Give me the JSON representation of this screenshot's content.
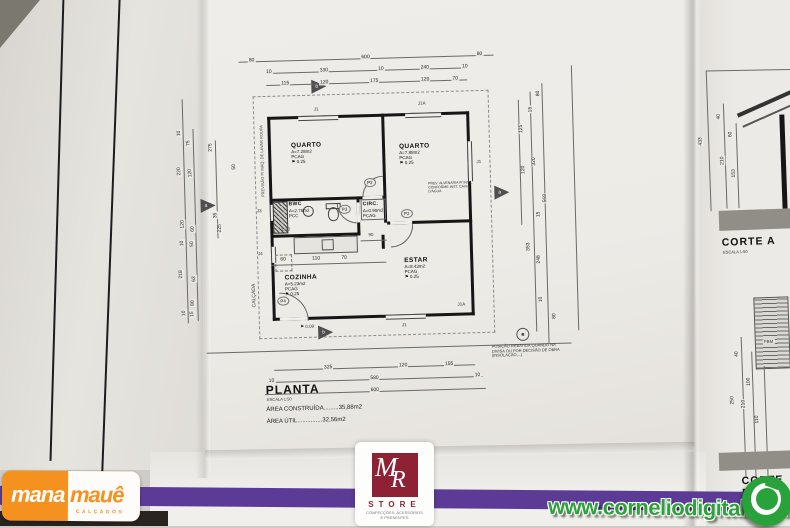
{
  "plan": {
    "title": "PLANTA",
    "scale": "ESCALA 1:50",
    "area_built": "ÁREA CONSTRUÍDA.........35,88m2",
    "area_net": "ÁREA ÚTIL...............32,56m2",
    "note_lines": [
      "POSIÇÃO REBATIDA QUANDO NA",
      "DIVISA OU POR DECISÃO DE OBRA",
      "(INSOLAÇÃO,...)"
    ],
    "annotation_lines": [
      "PREV. ALVENARIA P/ INST.",
      "CONFORME INST. CAIXA",
      "D'ÁGUA"
    ],
    "sidewalk_label": "CALÇADA",
    "laundry_note": "PREVISÃO P/ MÁQ. DE LAVAR ROUPA",
    "outside_level": "0.09",
    "rooms": [
      {
        "name": "QUARTO",
        "area": "A=7.28m2",
        "finish": "PCAG",
        "level": "0.25"
      },
      {
        "name": "QUARTO",
        "area": "A=7.88m2",
        "finish": "PCAG",
        "level": "0.25"
      },
      {
        "name": "BWC",
        "area": "A=2.76m2",
        "finish": "PCC",
        "level": "0.22"
      },
      {
        "name": "CIRC.",
        "area": "A=0.90m2",
        "finish": "PCAG",
        "level": "0.25"
      },
      {
        "name": "COZINHA",
        "area": "A=5.23m2",
        "finish": "PCAG",
        "level": "0.25"
      },
      {
        "name": "ESTAR",
        "area": "A=8.43m2",
        "finish": "PCAG",
        "level": "0.25"
      }
    ],
    "doors": [
      "P2",
      "P2",
      "P3",
      "P4"
    ],
    "windows": [
      "J1",
      "J1A",
      "J1",
      "J1",
      "J1A",
      "J3",
      "J4"
    ],
    "section_markers": [
      "b",
      "a",
      "a",
      "b"
    ],
    "bwc_height_note": "2.30",
    "dims": {
      "top_row_outer": [
        "80",
        "600",
        "80"
      ],
      "top_row_mid": [
        "10",
        "330",
        "10",
        "240",
        "10"
      ],
      "top_row_inner": [
        "115",
        "120",
        "175",
        "120",
        "70"
      ],
      "bottom_inner": [
        "325",
        "120",
        "155"
      ],
      "bottom_mid": [
        "10",
        "580",
        "10"
      ],
      "bottom_outer": [
        "600"
      ],
      "left": [
        "10",
        "75",
        "275",
        "220",
        "120",
        "50",
        "35",
        "120",
        "60",
        "225",
        "10",
        "50",
        "218",
        "63",
        "80",
        "10",
        "15"
      ],
      "right": [
        "80",
        "15",
        "125",
        "320",
        "120",
        "568",
        "15",
        "353",
        "248",
        "10",
        "80"
      ],
      "kitchen": [
        "60",
        "110",
        "70"
      ],
      "circ_width": "90"
    }
  },
  "corte_a": {
    "title": "CORTE A",
    "scale": "ESCALA 1:50",
    "dims": [
      "433",
      "40",
      "60",
      "210",
      "153"
    ]
  },
  "corte_b": {
    "title": "CORTE B",
    "scale": "ESCALA 1:50",
    "hatch_label": "FBM",
    "dims": [
      "40",
      "100",
      "250",
      "210",
      "110"
    ]
  },
  "watermarks": {
    "manamaue": {
      "part1": "mana",
      "part2": "mauê",
      "subtitle": "CALÇADOS",
      "orange": "#f5921f"
    },
    "mr_store": {
      "mono_m": "M",
      "mono_r": "R",
      "store": "STORE",
      "sub1": "CONFECÇÕES, ACESSÓRIOS",
      "sub2": "E PRESENTES",
      "red": "#8e2234"
    },
    "cornelio": {
      "url": "www.corneliodigital.com",
      "green": "#2da13c"
    },
    "band_color": "#5c3b96"
  }
}
